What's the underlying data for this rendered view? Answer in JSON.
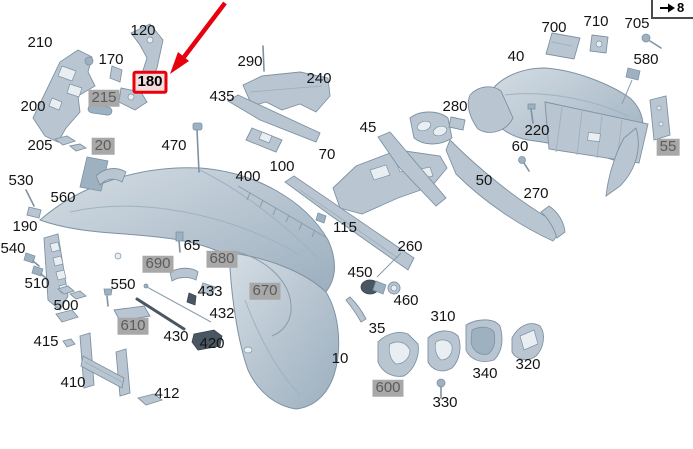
{
  "canvas": {
    "width": 693,
    "height": 449,
    "background": "#ffffff"
  },
  "nav": {
    "page_link": {
      "icon": "arrow-right-icon",
      "label": "8"
    }
  },
  "highlight": {
    "part": "180",
    "note": "red arrow pointing to red-boxed label 180"
  },
  "colors": {
    "part_fill": "#b9c6d2",
    "part_shade": "#9db1c0",
    "part_stroke": "#7e92a3",
    "dark_part": "#4a5662",
    "gray_label_bg": "#a8a8a8",
    "gray_label_text": "#5c5c5c",
    "highlight_red": "#e8000d"
  },
  "labels": [
    {
      "text": "210",
      "x": 40,
      "y": 43,
      "style": "plain"
    },
    {
      "text": "120",
      "x": 143,
      "y": 31,
      "style": "plain"
    },
    {
      "text": "170",
      "x": 111,
      "y": 60,
      "style": "plain"
    },
    {
      "text": "180",
      "x": 150,
      "y": 82,
      "style": "red"
    },
    {
      "text": "200",
      "x": 33,
      "y": 107,
      "style": "plain"
    },
    {
      "text": "215",
      "x": 104,
      "y": 98,
      "style": "gray"
    },
    {
      "text": "205",
      "x": 40,
      "y": 146,
      "style": "plain"
    },
    {
      "text": "20",
      "x": 103,
      "y": 146,
      "style": "gray"
    },
    {
      "text": "470",
      "x": 174,
      "y": 146,
      "style": "plain"
    },
    {
      "text": "435",
      "x": 222,
      "y": 97,
      "style": "plain"
    },
    {
      "text": "290",
      "x": 250,
      "y": 62,
      "style": "plain"
    },
    {
      "text": "240",
      "x": 319,
      "y": 79,
      "style": "plain"
    },
    {
      "text": "45",
      "x": 368,
      "y": 128,
      "style": "plain"
    },
    {
      "text": "280",
      "x": 455,
      "y": 107,
      "style": "plain"
    },
    {
      "text": "40",
      "x": 516,
      "y": 57,
      "style": "plain"
    },
    {
      "text": "700",
      "x": 554,
      "y": 28,
      "style": "plain"
    },
    {
      "text": "710",
      "x": 596,
      "y": 22,
      "style": "plain"
    },
    {
      "text": "705",
      "x": 637,
      "y": 24,
      "style": "plain"
    },
    {
      "text": "580",
      "x": 646,
      "y": 60,
      "style": "plain"
    },
    {
      "text": "220",
      "x": 537,
      "y": 131,
      "style": "plain"
    },
    {
      "text": "60",
      "x": 520,
      "y": 147,
      "style": "plain"
    },
    {
      "text": "55",
      "x": 668,
      "y": 147,
      "style": "gray"
    },
    {
      "text": "50",
      "x": 484,
      "y": 181,
      "style": "plain"
    },
    {
      "text": "270",
      "x": 536,
      "y": 194,
      "style": "plain"
    },
    {
      "text": "70",
      "x": 327,
      "y": 155,
      "style": "plain"
    },
    {
      "text": "100",
      "x": 282,
      "y": 167,
      "style": "plain"
    },
    {
      "text": "400",
      "x": 248,
      "y": 177,
      "style": "plain"
    },
    {
      "text": "115",
      "x": 345,
      "y": 228,
      "style": "plain"
    },
    {
      "text": "260",
      "x": 410,
      "y": 247,
      "style": "plain"
    },
    {
      "text": "530",
      "x": 21,
      "y": 181,
      "style": "plain"
    },
    {
      "text": "560",
      "x": 63,
      "y": 198,
      "style": "plain"
    },
    {
      "text": "190",
      "x": 25,
      "y": 227,
      "style": "plain"
    },
    {
      "text": "540",
      "x": 13,
      "y": 249,
      "style": "plain"
    },
    {
      "text": "510",
      "x": 37,
      "y": 284,
      "style": "plain"
    },
    {
      "text": "500",
      "x": 66,
      "y": 306,
      "style": "plain"
    },
    {
      "text": "550",
      "x": 123,
      "y": 285,
      "style": "plain"
    },
    {
      "text": "65",
      "x": 192,
      "y": 246,
      "style": "plain"
    },
    {
      "text": "690",
      "x": 158,
      "y": 264,
      "style": "gray"
    },
    {
      "text": "680",
      "x": 222,
      "y": 259,
      "style": "gray"
    },
    {
      "text": "670",
      "x": 265,
      "y": 291,
      "style": "gray"
    },
    {
      "text": "433",
      "x": 210,
      "y": 292,
      "style": "plain"
    },
    {
      "text": "432",
      "x": 222,
      "y": 314,
      "style": "plain"
    },
    {
      "text": "610",
      "x": 133,
      "y": 326,
      "style": "gray"
    },
    {
      "text": "430",
      "x": 176,
      "y": 337,
      "style": "plain"
    },
    {
      "text": "420",
      "x": 212,
      "y": 344,
      "style": "plain"
    },
    {
      "text": "415",
      "x": 46,
      "y": 342,
      "style": "plain"
    },
    {
      "text": "410",
      "x": 73,
      "y": 383,
      "style": "plain"
    },
    {
      "text": "412",
      "x": 167,
      "y": 394,
      "style": "plain"
    },
    {
      "text": "10",
      "x": 340,
      "y": 359,
      "style": "plain"
    },
    {
      "text": "450",
      "x": 360,
      "y": 273,
      "style": "plain"
    },
    {
      "text": "460",
      "x": 406,
      "y": 301,
      "style": "plain"
    },
    {
      "text": "35",
      "x": 377,
      "y": 329,
      "style": "plain"
    },
    {
      "text": "600",
      "x": 388,
      "y": 388,
      "style": "gray"
    },
    {
      "text": "310",
      "x": 443,
      "y": 317,
      "style": "plain"
    },
    {
      "text": "330",
      "x": 445,
      "y": 403,
      "style": "plain"
    },
    {
      "text": "340",
      "x": 485,
      "y": 374,
      "style": "plain"
    },
    {
      "text": "320",
      "x": 528,
      "y": 365,
      "style": "plain"
    }
  ]
}
